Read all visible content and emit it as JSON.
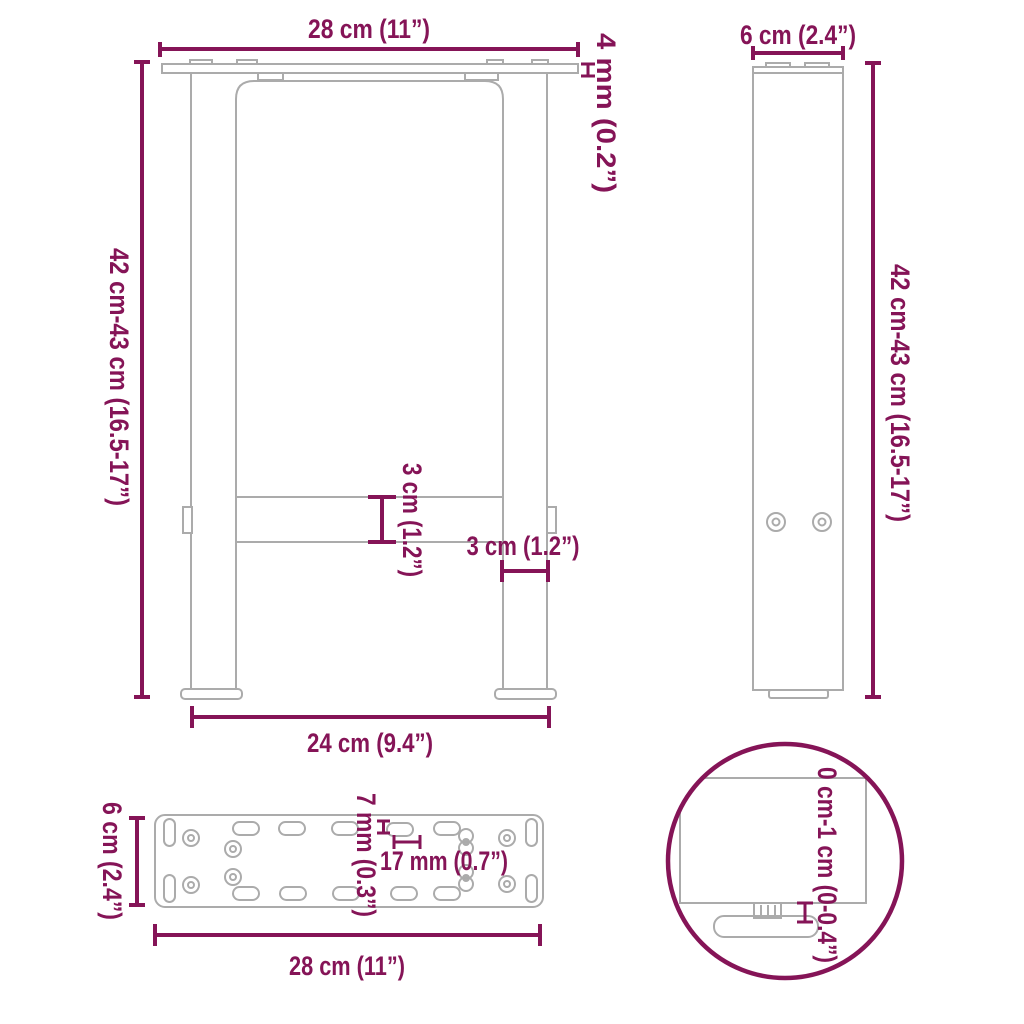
{
  "colors": {
    "accent": "#851457",
    "outline": "#ababab"
  },
  "front_view": {
    "top_width": "28 cm (11”)",
    "plate_thickness": "4 mm (0.2”)",
    "height": "42 cm-43 cm (16.5-17”)",
    "crossbar_height": "3 cm (1.2”)",
    "leg_width": "3 cm (1.2”)",
    "feet_span": "24 cm (9.4”)"
  },
  "side_view": {
    "depth": "6 cm (2.4”)",
    "height": "42 cm-43 cm (16.5-17”)"
  },
  "plate_view": {
    "depth": "6 cm (2.4”)",
    "slot_height": "7 mm (0.3”)",
    "slot_length": "17 mm (0.7”)",
    "width": "28 cm (11”)"
  },
  "foot_detail": {
    "height_adjustment": "0 cm-1 cm (0-0.4”)"
  }
}
